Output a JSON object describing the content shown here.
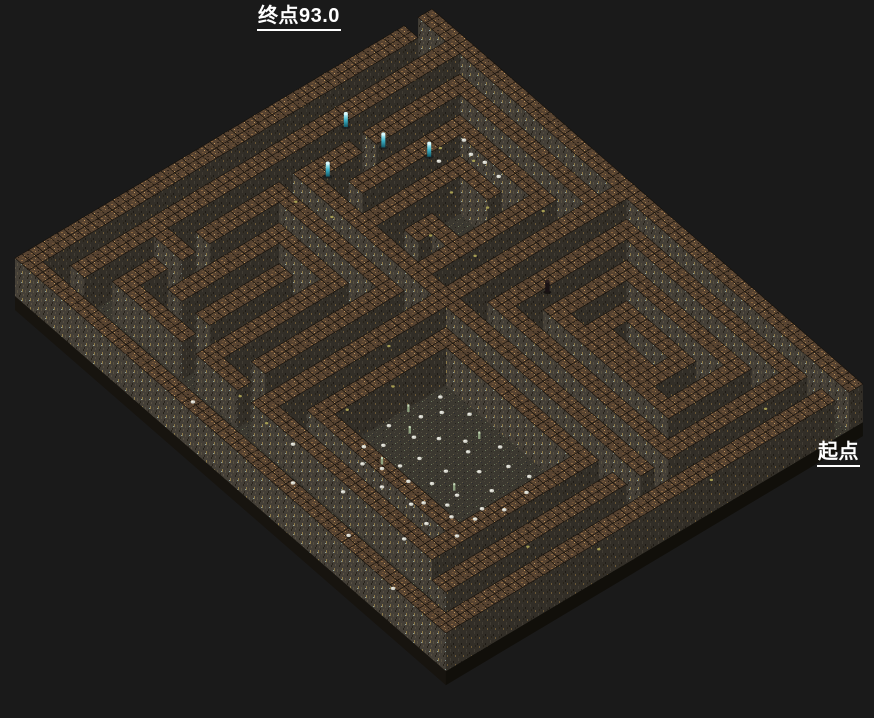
{
  "labels": {
    "end": {
      "text": "终点93.0"
    },
    "start": {
      "text": "起点"
    }
  },
  "maze": {
    "projection": {
      "origin": [
        432,
        47
      ],
      "col_step": [
        6.95,
        6.05
      ],
      "row_step": [
        -6.95,
        4.15
      ],
      "grid_scale": 2,
      "wall_height": 38,
      "base_height": 14
    },
    "grid": [
      "###############################",
      "..#...........#................",
      "#.#.###########.#############.#",
      "#.#.#.........#.#...........#.#",
      "#.#.#.#######.#.#.#########.#.#",
      "#.#.#.#.....#.#.#.#.......#.#.#",
      "#.#.#.#.###.#.#.#.#.#####.#.#.#",
      "#.#.#.#.#...#.#.#.#.#...#.#.#.#",
      "#.#.#.#.#...#.#.#.#.#####.#.#.#",
      "#.#...#.#...#.#.#.#########.#.#",
      "#.#.#.#.#.###.#.#...........#.#",
      "#.#.#.#.#.#.#.#.#############.#",
      "#.#.#...#...#.#...............#",
      "#.#.#########################.#",
      "#.#...........#...............#",
      "#.#.#########.#.###########.#.#",
      "#.#.#.......#.#.#.........#.#.#",
      "#.#.#.#####.#.#.#.........#.#.#",
      "#.#.#.#...#.#.#.#.........#.#.#",
      "#.#.#.#.#.#.#.#.#.........#.#.#",
      "#.#.#.#.#.#.#.#.#.........#.#.#",
      "#.#...#.#.#.#.#.#.........#.#.#",
      "#.###.#.#.#.#.#.#.........#.#.#",
      "#.#...#.#.#.#.#.#.........#.#.#",
      "#.#.#.#.#.#.#.#.###########.#.#",
      "#.#.#.....#...#...........#.#.#",
      "#.#.#####.###.#############.#.#",
      "#.#.........................#.#",
      "#.............................#",
      "###############################"
    ],
    "colors": {
      "background": "#1a1a1a",
      "cap_base": "#574331",
      "cap_specks": [
        "#8f6a40",
        "#c4995c",
        "#30241a",
        "#6f5335",
        "#a07c48",
        "#241b12"
      ],
      "face_sw_base": "#443f37",
      "face_sw_specks": [
        "#575040",
        "#2b261f",
        "#8d7a4a",
        "#262219",
        "#8fa39e",
        "#5a5244"
      ],
      "face_se_base": "#322e27",
      "face_se_specks": [
        "#423d34",
        "#1e1a15",
        "#6b5836",
        "#282319"
      ],
      "floor_base": "#3b3830",
      "floor_specks": [
        "#55503e",
        "#24211b",
        "#4a453a",
        "#605a46",
        "#6f7a5f",
        "#2c2c30"
      ],
      "slab_sw": "#17140f",
      "slab_se": "#110f0a",
      "cap_stroke": "#14100b",
      "white_dot": "#d4d4cb",
      "yellow_dot": "#b3aa58",
      "green_sprite": "#97ad88",
      "cyan_top": "#c8f8ff",
      "cyan_mid": "#3fb6cc",
      "cyan_low": "#135968",
      "dark_figure": "#191113"
    }
  },
  "decorations": {
    "white_dots": [
      [
        17.4,
        16.8
      ],
      [
        18.2,
        17.5
      ],
      [
        19.1,
        16.4
      ],
      [
        20.3,
        17.9
      ],
      [
        21.6,
        16.7
      ],
      [
        22.8,
        17.3
      ],
      [
        23.9,
        16.9
      ],
      [
        24.6,
        17.8
      ],
      [
        17.8,
        18.6
      ],
      [
        19.4,
        18.9
      ],
      [
        20.9,
        18.3
      ],
      [
        22.2,
        18.8
      ],
      [
        23.5,
        19.2
      ],
      [
        24.8,
        19.6
      ],
      [
        18.6,
        19.9
      ],
      [
        17.3,
        20.4
      ],
      [
        19.8,
        20.7
      ],
      [
        21.2,
        20.2
      ],
      [
        22.7,
        20.9
      ],
      [
        24.1,
        20.5
      ],
      [
        18.1,
        21.6
      ],
      [
        19.6,
        21.9
      ],
      [
        21.4,
        21.4
      ],
      [
        22.9,
        21.8
      ],
      [
        24.4,
        21.3
      ],
      [
        17.6,
        22.5
      ],
      [
        19.2,
        22.8
      ],
      [
        20.6,
        22.3
      ],
      [
        22.1,
        22.7
      ],
      [
        23.6,
        22.2
      ],
      [
        24.7,
        22.9
      ],
      [
        18.4,
        23.4
      ],
      [
        20.1,
        23.7
      ],
      [
        21.8,
        23.3
      ],
      [
        23.2,
        23.6
      ],
      [
        5.5,
        3.2
      ],
      [
        7.2,
        3.4
      ],
      [
        6.4,
        3.6
      ],
      [
        8.3,
        3.5
      ],
      [
        5.8,
        5.3
      ],
      [
        15.4,
        25.4
      ],
      [
        17.3,
        27.3
      ],
      [
        21.5,
        27.5
      ],
      [
        25.4,
        28.2
      ],
      [
        10.4,
        27.6
      ],
      [
        19.2,
        25.6
      ],
      [
        23.3,
        25.3
      ]
    ],
    "yellow_dots": [
      [
        5.2,
        4.6
      ],
      [
        6.8,
        3.8
      ],
      [
        9.5,
        5.5
      ],
      [
        7.7,
        6.3
      ],
      [
        11.3,
        3.3
      ],
      [
        11.5,
        8.4
      ],
      [
        9.2,
        9.3
      ],
      [
        3.6,
        13.4
      ],
      [
        5.4,
        12.6
      ],
      [
        13.4,
        16.5
      ],
      [
        15.5,
        18.3
      ],
      [
        15.3,
        21.4
      ],
      [
        13.6,
        25.5
      ],
      [
        11.5,
        25.3
      ],
      [
        27.5,
        3.5
      ],
      [
        29.4,
        9.3
      ],
      [
        27.3,
        20.4
      ],
      [
        29.5,
        17.5
      ]
    ],
    "green_sprites": [
      [
        18.3,
        19.9
      ],
      [
        20.6,
        17.2
      ],
      [
        22.4,
        20.8
      ],
      [
        19.0,
        22.6
      ],
      [
        17.2,
        18.9
      ]
    ],
    "cyan_figures": [
      [
        1.4,
        7.6
      ],
      [
        3.5,
        7.0
      ],
      [
        3.3,
        10.8
      ],
      [
        5.3,
        5.5
      ]
    ],
    "dark_figures": [
      [
        15.4,
        7.1
      ]
    ]
  }
}
